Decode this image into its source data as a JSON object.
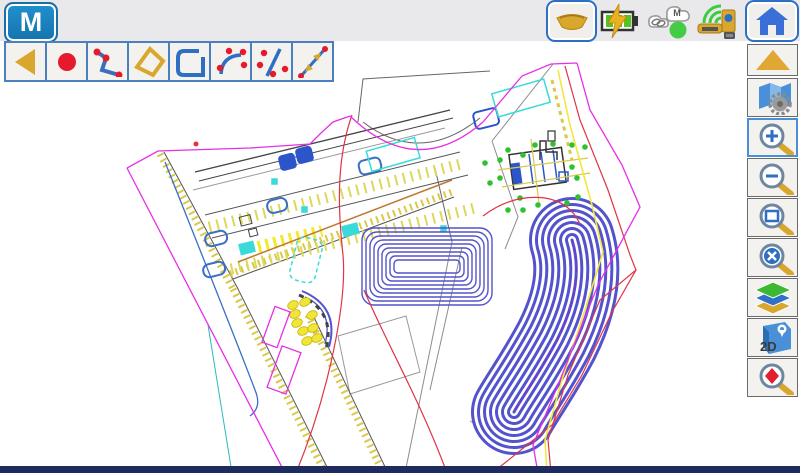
{
  "app": {
    "logo": "M",
    "accent_color": "#1b7fc2",
    "toolbar_border_color": "#4a80c0",
    "bottom_bar_color": "#1d2b5e"
  },
  "draw_toolbar": {
    "buttons": [
      {
        "icon": "back-triangle-icon"
      },
      {
        "icon": "point-icon"
      },
      {
        "icon": "polyline-icon"
      },
      {
        "icon": "polygon-icon"
      },
      {
        "icon": "closed-boundary-icon"
      },
      {
        "icon": "arc-through-points-icon"
      },
      {
        "icon": "offset-line-icon"
      },
      {
        "icon": "line-arrows-icon"
      }
    ]
  },
  "status_bar": {
    "icons": [
      {
        "icon": "prism-icon"
      },
      {
        "icon": "battery-charging-icon"
      },
      {
        "icon": "cloud-connection-icon",
        "cloud_label": "M"
      },
      {
        "icon": "instrument-connected-icon"
      },
      {
        "icon": "home-icon"
      }
    ]
  },
  "sidebar": {
    "buttons": [
      {
        "icon": "up-triangle-icon",
        "selected": false
      },
      {
        "icon": "map-settings-icon",
        "selected": false
      },
      {
        "icon": "zoom-in-icon",
        "selected": true
      },
      {
        "icon": "zoom-out-icon",
        "selected": false
      },
      {
        "icon": "zoom-window-icon",
        "selected": false
      },
      {
        "icon": "zoom-extents-icon",
        "selected": false
      },
      {
        "icon": "layers-icon",
        "selected": false
      },
      {
        "icon": "view-2d-icon",
        "selected": false,
        "label": "2D"
      },
      {
        "icon": "find-point-icon",
        "selected": false
      }
    ]
  },
  "map": {
    "colors": {
      "boundary_magenta": "#e82ee8",
      "design_red": "#e03444",
      "contour_blue": "#5353ce",
      "stall_yellow": "#f0e63a",
      "curb_gold": "#d9c84a",
      "utility_cyan": "#3adada",
      "point_green": "#2ec22e",
      "existing_gray": "#8c8c8c",
      "orange_line": "#c07830"
    },
    "layers": [
      "site-boundary-magenta",
      "roads-existing-gray",
      "curbs-gold-hatched",
      "parking-stalls-yellow",
      "buildings-dark",
      "islands-blue",
      "utilities-cyan",
      "stockpile-contours-blue-rect",
      "stockpile-contours-blue-banana",
      "survey-points-green",
      "survey-points-yellow",
      "design-lines-red"
    ]
  }
}
